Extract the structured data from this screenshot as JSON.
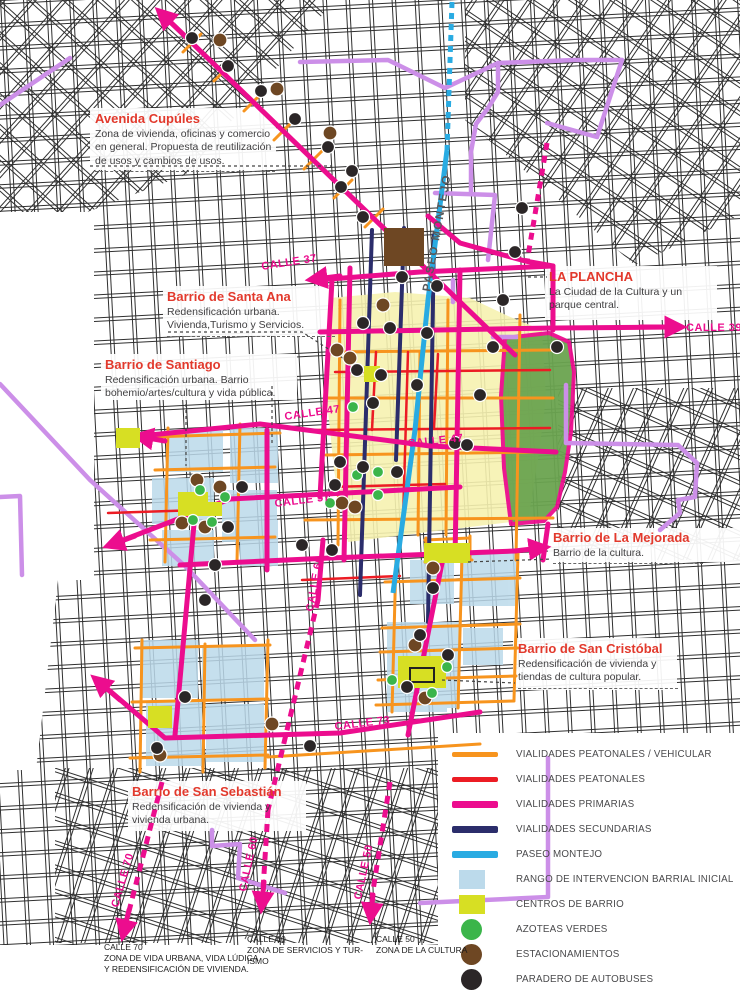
{
  "annotations": {
    "cupules": {
      "title": "Avenida Cupúles",
      "body": "Zona de vivienda, oficinas y comercio en general. Propuesta de reutilización de usos y cambios de usos."
    },
    "santa_ana": {
      "title": "Barrio de Santa Ana",
      "body": "Redensificación urbana. Vivienda,Turismo y Servicios."
    },
    "santiago": {
      "title": "Barrio de Santiago",
      "body": "Redensificación urbana. Barrio bohemio/artes/cultura y vida pública."
    },
    "la_plancha": {
      "title": "LA PLANCHA",
      "body": "La Ciudad de la Cultura y un parque central."
    },
    "mejorada": {
      "title": "Barrio de La Mejorada",
      "body": "Barrio de la cultura."
    },
    "san_cristobal": {
      "title": "Barrio de San Cristóbal",
      "body": "Redensificación de vivienda y tiendas de cultura popular."
    },
    "san_sebastian": {
      "title": "Barrio de San Sebastián",
      "body": "Redensificación de vivienda y vivienda urbana."
    }
  },
  "street_labels": {
    "paseo_montejo": "PASEO MONTEJO",
    "calle_37": "CALLE 37",
    "calle_39": "CALLE 39",
    "calle_47a": "CALLE 47",
    "calle_47b": "CALLE 47",
    "calle_57": "CALLE 57",
    "calle_60_mid": "CALLE 60",
    "calle_73": "CALLE 73",
    "calle_70": "CALLE 70",
    "calle_60_low": "CALLE 60",
    "calle_50": "CALLE 50"
  },
  "footnotes": [
    {
      "title": "CALLE 70",
      "body": "ZONA DE VIDA URBANA, VIDA LÚDICA Y REDENSIFICACIÓN DE VIVIENDA."
    },
    {
      "title": "CALLE 60",
      "body": "ZONA DE SERVICIOS Y TUR-ISMO"
    },
    {
      "title": "CALLE 50",
      "body": "ZONA DE LA CULTURA"
    }
  ],
  "legend": {
    "items": [
      {
        "label": "VIALIDADES PEATONALES / VEHICULAR",
        "type": "line",
        "color": "#F7941E"
      },
      {
        "label": "VIALIDADES PEATONALES",
        "type": "line",
        "color": "#EC1C24"
      },
      {
        "label": "VIALIDADES PRIMARIAS",
        "type": "line-thick",
        "color": "#EC0D8E"
      },
      {
        "label": "VIALIDADES SECUNDARIAS",
        "type": "line-thick",
        "color": "#2B2D6B"
      },
      {
        "label": "PASEO MONTEJO",
        "type": "line-thick",
        "color": "#29ABE2"
      },
      {
        "label": "RANGO DE INTERVENCION BARRIAL INICIAL",
        "type": "square",
        "color": "#BCDAEB"
      },
      {
        "label": "CENTROS DE BARRIO",
        "type": "square",
        "color": "#D7DF23"
      },
      {
        "label": "AZOTEAS VERDES",
        "type": "circle",
        "color": "#3BB54A"
      },
      {
        "label": "ESTACIONAMIENTOS",
        "type": "circle",
        "color": "#6E4723"
      },
      {
        "label": "PARADERO DE AUTOBUSES",
        "type": "circle",
        "color": "#2B2627"
      }
    ]
  },
  "colors": {
    "primary_road": "#EC0D8E",
    "secondary_road": "#2B2D6B",
    "pedestrian_vehicular_road": "#F7941E",
    "pedestrian_road": "#EC1C24",
    "paseo_montejo_line": "#29ABE2",
    "violet_road": "#CC8FE8",
    "intervention_zone": "#BCDAEB",
    "barrio_center": "#D7DF23",
    "park_green": "#6BA450",
    "central_zone_yellow": "#F6F2B0",
    "green_roof": "#3BB54A",
    "parking": "#6E4723",
    "bus_stop": "#2B2627",
    "heading_red": "#E2392C"
  },
  "markers": {
    "bus_stops": [
      [
        192,
        38
      ],
      [
        228,
        66
      ],
      [
        261,
        91
      ],
      [
        295,
        119
      ],
      [
        328,
        147
      ],
      [
        352,
        171
      ],
      [
        341,
        187
      ],
      [
        363,
        217
      ],
      [
        522,
        208
      ],
      [
        515,
        252
      ],
      [
        402,
        277
      ],
      [
        437,
        286
      ],
      [
        503,
        300
      ],
      [
        557,
        347
      ],
      [
        363,
        323
      ],
      [
        390,
        328
      ],
      [
        427,
        333
      ],
      [
        493,
        347
      ],
      [
        357,
        370
      ],
      [
        381,
        375
      ],
      [
        417,
        385
      ],
      [
        480,
        395
      ],
      [
        373,
        403
      ],
      [
        455,
        443
      ],
      [
        467,
        445
      ],
      [
        340,
        462
      ],
      [
        363,
        467
      ],
      [
        397,
        472
      ],
      [
        335,
        485
      ],
      [
        242,
        487
      ],
      [
        228,
        527
      ],
      [
        302,
        545
      ],
      [
        332,
        550
      ],
      [
        215,
        565
      ],
      [
        205,
        600
      ],
      [
        433,
        588
      ],
      [
        420,
        635
      ],
      [
        407,
        687
      ],
      [
        448,
        655
      ],
      [
        185,
        697
      ],
      [
        157,
        748
      ],
      [
        310,
        746
      ]
    ],
    "parking": [
      [
        220,
        40
      ],
      [
        277,
        89
      ],
      [
        330,
        133
      ],
      [
        383,
        305
      ],
      [
        337,
        350
      ],
      [
        350,
        358
      ],
      [
        342,
        503
      ],
      [
        355,
        507
      ],
      [
        197,
        480
      ],
      [
        220,
        487
      ],
      [
        182,
        523
      ],
      [
        205,
        527
      ],
      [
        433,
        568
      ],
      [
        415,
        645
      ],
      [
        425,
        698
      ],
      [
        272,
        724
      ],
      [
        160,
        755
      ]
    ],
    "green_roofs": [
      [
        353,
        407
      ],
      [
        378,
        472
      ],
      [
        357,
        475
      ],
      [
        378,
        495
      ],
      [
        330,
        503
      ],
      [
        200,
        490
      ],
      [
        225,
        497
      ],
      [
        193,
        520
      ],
      [
        212,
        522
      ],
      [
        447,
        667
      ],
      [
        392,
        680
      ],
      [
        432,
        693
      ]
    ]
  }
}
